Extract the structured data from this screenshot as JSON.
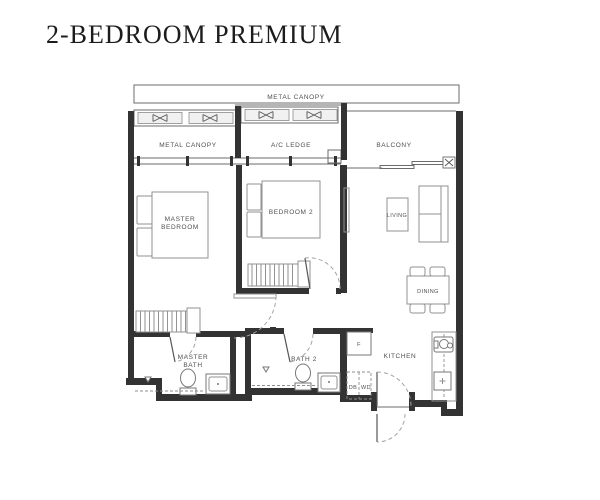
{
  "title": "2-BEDROOM PREMIUM",
  "plan": {
    "banner": "METAL CANOPY",
    "labels": {
      "metal_canopy": "METAL CANOPY",
      "ac_ledge": "A/C LEDGE",
      "balcony": "BALCONY",
      "master_bedroom_l1": "MASTER",
      "master_bedroom_l2": "BEDROOM",
      "bedroom2": "BEDROOM 2",
      "living": "LIVING",
      "dining": "DINING",
      "master_bath_l1": "MASTER",
      "master_bath_l2": "BATH",
      "bath2": "BATH 2",
      "kitchen": "KITCHEN",
      "fridge": "F",
      "db": "DB",
      "wd": "WD"
    },
    "colors": {
      "wall": "#333333",
      "furniture_line": "#929292",
      "text": "#4f4f4f",
      "title": "#1c1c1c",
      "background": "#ffffff"
    }
  }
}
